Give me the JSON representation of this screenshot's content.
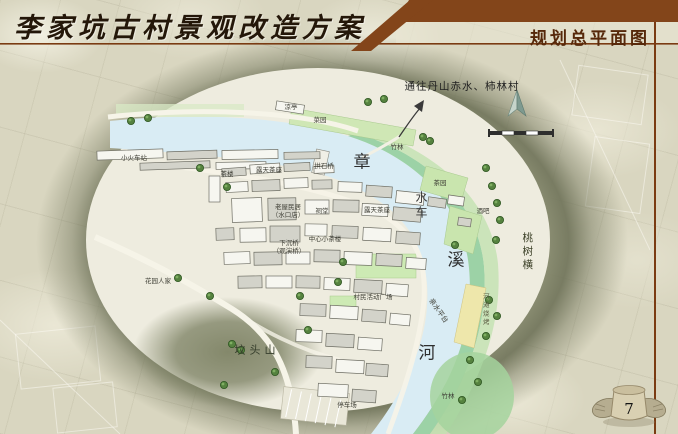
{
  "header": {
    "title": "李家坑古村景观改造方案",
    "subtitle": "规划总平面图"
  },
  "page": {
    "number": "7"
  },
  "map": {
    "route_note": "通往丹山赤水、柿林村",
    "river_name": {
      "char_1": "章",
      "char_2": "溪",
      "char_3": "河"
    },
    "labels": {
      "train_station": "小火车站",
      "pavilion": "凉亭",
      "vegetable_garden": "菜园",
      "bamboo_grove_top": "竹林",
      "tea_house": "茶楼",
      "open_air_tea_seats_1": "露天茶座",
      "arch_stone_bridge": "拱石桥",
      "open_air_tea_seats_2": "露天茶座",
      "old_houses": "老屋民居",
      "old_houses_note": "（水口店）",
      "ancestral_hall": "祠堂",
      "sunken_bridge": "下沉桥",
      "sunken_bridge_note": "（观演桥）",
      "central_tea_house": "中心小茶楼",
      "garden_homes": "花园人家",
      "villager_plaza": "村民活动广场",
      "fentou_hill": "坟头山",
      "waterwheel": "水车",
      "tea_garden": "茶园",
      "bar": "酒吧",
      "peach_tree_row": "桃树横",
      "river_beach_bbq": "河滩烧烤",
      "waterfront_platform": "亲水平台",
      "parking_lot": "停车场",
      "bamboo_grove_bottom": "竹林"
    },
    "buildings": [
      [
        97,
        150,
        66,
        9,
        -2,
        0
      ],
      [
        167,
        151,
        50,
        8,
        -2,
        1
      ],
      [
        222,
        150,
        56,
        9,
        -1,
        0
      ],
      [
        284,
        152,
        36,
        7,
        -1,
        1
      ],
      [
        140,
        162,
        70,
        7,
        -2,
        1
      ],
      [
        216,
        162,
        50,
        7,
        -1,
        0
      ],
      [
        276,
        103,
        28,
        9,
        9,
        0
      ],
      [
        209,
        176,
        11,
        26,
        0,
        0
      ],
      [
        222,
        168,
        24,
        8,
        -4,
        1
      ],
      [
        250,
        164,
        30,
        9,
        -4,
        0
      ],
      [
        284,
        163,
        26,
        8,
        -3,
        1
      ],
      [
        314,
        166,
        20,
        7,
        -2,
        0
      ],
      [
        226,
        182,
        22,
        10,
        -3,
        0
      ],
      [
        252,
        180,
        28,
        11,
        -2,
        1
      ],
      [
        284,
        178,
        24,
        10,
        -2,
        0
      ],
      [
        312,
        180,
        20,
        9,
        -1,
        1
      ],
      [
        338,
        182,
        24,
        10,
        2,
        0
      ],
      [
        366,
        186,
        26,
        11,
        4,
        1
      ],
      [
        396,
        192,
        28,
        12,
        6,
        0
      ],
      [
        428,
        198,
        18,
        9,
        8,
        1
      ],
      [
        232,
        198,
        30,
        24,
        -2,
        0
      ],
      [
        268,
        198,
        28,
        22,
        -1,
        1
      ],
      [
        305,
        200,
        24,
        14,
        0,
        0
      ],
      [
        333,
        200,
        26,
        12,
        1,
        1
      ],
      [
        362,
        204,
        26,
        12,
        3,
        0
      ],
      [
        393,
        208,
        28,
        13,
        5,
        1
      ],
      [
        216,
        228,
        18,
        12,
        -2,
        1
      ],
      [
        240,
        228,
        26,
        14,
        -1,
        0
      ],
      [
        270,
        226,
        30,
        16,
        0,
        1
      ],
      [
        305,
        224,
        22,
        12,
        1,
        0
      ],
      [
        332,
        226,
        26,
        12,
        2,
        1
      ],
      [
        363,
        228,
        28,
        13,
        3,
        0
      ],
      [
        396,
        232,
        24,
        12,
        4,
        1
      ],
      [
        224,
        252,
        26,
        12,
        -2,
        0
      ],
      [
        254,
        252,
        28,
        13,
        -1,
        1
      ],
      [
        286,
        252,
        24,
        12,
        0,
        0
      ],
      [
        314,
        250,
        26,
        12,
        1,
        1
      ],
      [
        344,
        252,
        28,
        13,
        2,
        0
      ],
      [
        376,
        254,
        26,
        12,
        3,
        1
      ],
      [
        406,
        258,
        20,
        11,
        4,
        0
      ],
      [
        238,
        276,
        24,
        12,
        -1,
        1
      ],
      [
        266,
        276,
        26,
        12,
        0,
        0
      ],
      [
        296,
        276,
        24,
        12,
        1,
        1
      ],
      [
        324,
        278,
        26,
        12,
        2,
        0
      ],
      [
        354,
        280,
        28,
        13,
        3,
        1
      ],
      [
        386,
        284,
        22,
        12,
        4,
        0
      ],
      [
        300,
        304,
        26,
        12,
        2,
        1
      ],
      [
        330,
        306,
        28,
        13,
        3,
        0
      ],
      [
        362,
        310,
        24,
        12,
        4,
        1
      ],
      [
        390,
        314,
        20,
        11,
        5,
        0
      ],
      [
        296,
        330,
        26,
        12,
        2,
        0
      ],
      [
        326,
        334,
        28,
        13,
        3,
        1
      ],
      [
        358,
        338,
        24,
        12,
        4,
        0
      ],
      [
        306,
        356,
        26,
        12,
        2,
        1
      ],
      [
        336,
        360,
        28,
        13,
        3,
        0
      ],
      [
        366,
        364,
        22,
        12,
        4,
        1
      ],
      [
        318,
        384,
        30,
        13,
        3,
        0
      ],
      [
        352,
        390,
        24,
        12,
        4,
        1
      ],
      [
        448,
        196,
        16,
        9,
        8,
        0
      ],
      [
        458,
        218,
        13,
        8,
        8,
        1
      ]
    ],
    "trees": [
      [
        368,
        102
      ],
      [
        384,
        99
      ],
      [
        423,
        137
      ],
      [
        430,
        141
      ],
      [
        200,
        168
      ],
      [
        227,
        187
      ],
      [
        131,
        121
      ],
      [
        148,
        118
      ],
      [
        178,
        278
      ],
      [
        210,
        296
      ],
      [
        232,
        344
      ],
      [
        241,
        350
      ],
      [
        224,
        385
      ],
      [
        275,
        372
      ],
      [
        343,
        262
      ],
      [
        338,
        282
      ],
      [
        308,
        330
      ],
      [
        486,
        168
      ],
      [
        492,
        186
      ],
      [
        497,
        203
      ],
      [
        500,
        220
      ],
      [
        496,
        240
      ],
      [
        455,
        245
      ],
      [
        489,
        300
      ],
      [
        497,
        316
      ],
      [
        486,
        336
      ],
      [
        470,
        360
      ],
      [
        478,
        382
      ],
      [
        462,
        400
      ],
      [
        300,
        296
      ]
    ]
  },
  "colors": {
    "header_brown": "#83451a",
    "rule_brown": "#7a3b12",
    "stone_background": "#d9d6c0",
    "hill_olive": "#6e7258",
    "water_blue": "#d9ecf4",
    "bank_green": "#9cd2a6",
    "garden_green": "#c9e5ae",
    "beach_yellow": "#eee7ab",
    "title_ink": "#241709"
  }
}
